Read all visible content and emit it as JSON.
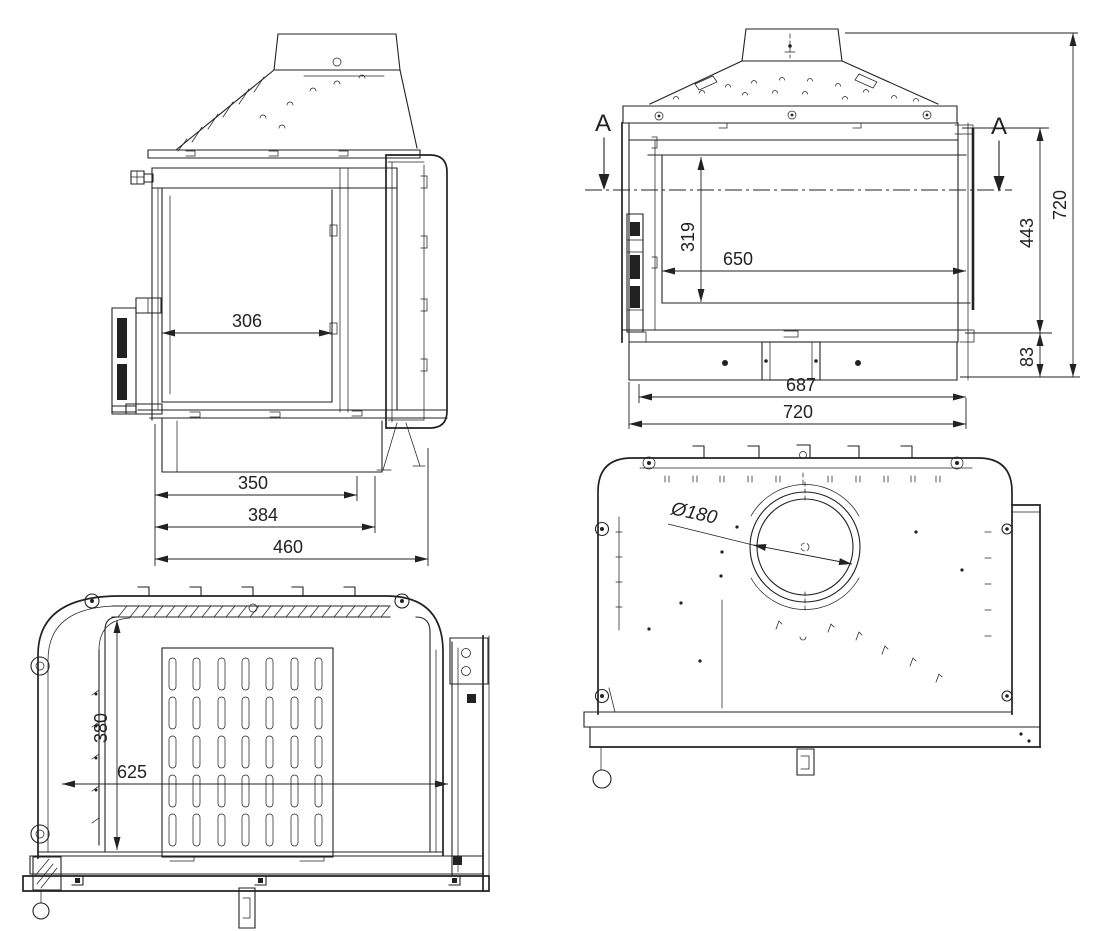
{
  "colors": {
    "line": "#222222",
    "background": "#ffffff"
  },
  "views": {
    "side": {
      "dim_306": "306",
      "dim_350": "350",
      "dim_384": "384",
      "dim_460": "460"
    },
    "front": {
      "section_a_left": "A",
      "section_a_right": "A",
      "dim_319": "319",
      "dim_650": "650",
      "dim_443": "443",
      "dim_720_height": "720",
      "dim_83": "83",
      "dim_687": "687",
      "dim_720_width": "720"
    },
    "plan": {
      "dim_380": "380",
      "dim_625": "625"
    },
    "rear": {
      "dim_flue_diameter": "Ø180"
    }
  }
}
